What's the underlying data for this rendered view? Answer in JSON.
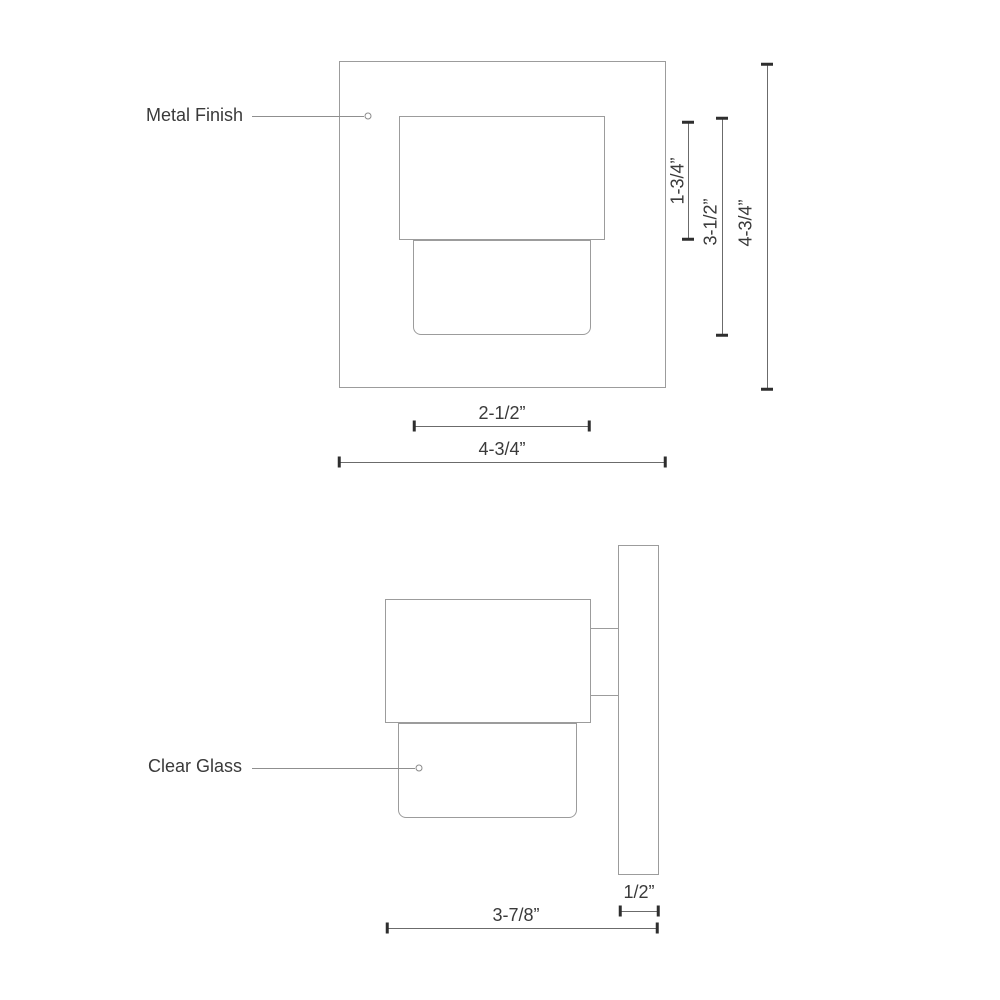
{
  "annotations": {
    "metal_finish": "Metal Finish",
    "clear_glass": "Clear Glass"
  },
  "front_view": {
    "dim_housing_height": "1-3/4”",
    "dim_body_height": "3-1/2”",
    "dim_backplate_height": "4-3/4”",
    "dim_glass_width": "2-1/2”",
    "dim_backplate_width": "4-3/4”"
  },
  "side_view": {
    "dim_plate_depth": "1/2”",
    "dim_total_depth": "3-7/8”"
  },
  "colors": {
    "outline": "#9c9c9c",
    "dimension_line": "#6b6b6b",
    "tick": "#2e2e2e",
    "text": "#3a3a3a",
    "background": "#ffffff"
  }
}
